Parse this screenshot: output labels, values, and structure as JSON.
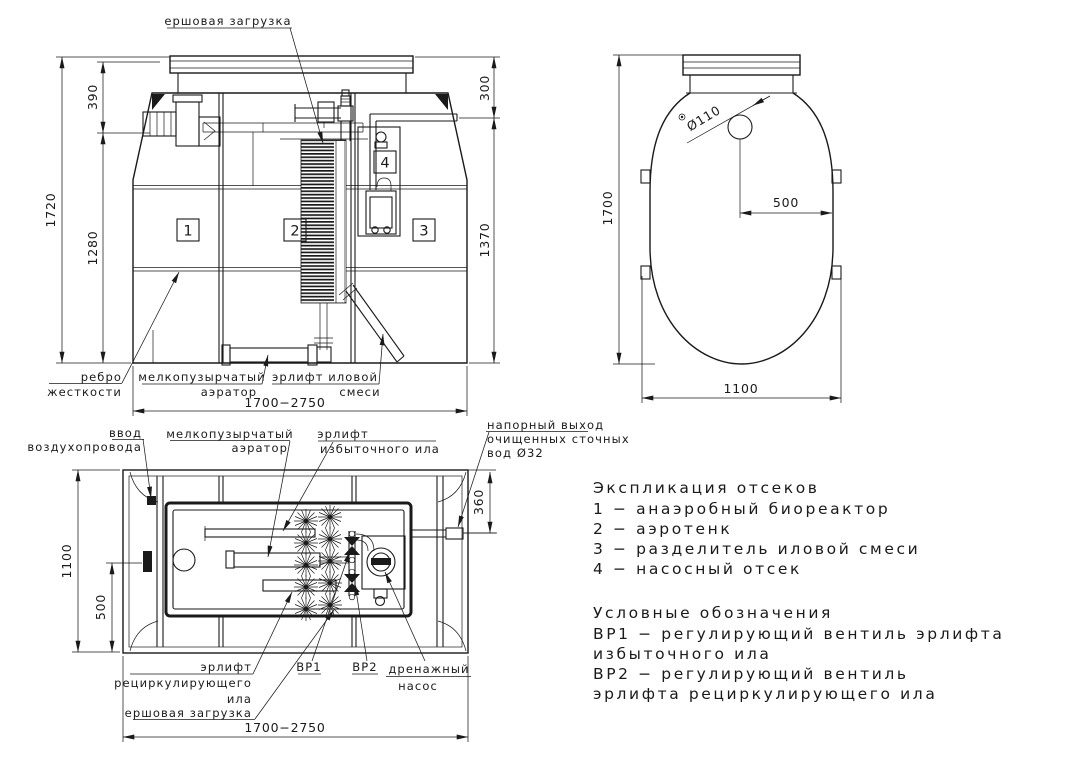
{
  "meta": {
    "ink": "#1a1a1a",
    "bg": "#ffffff",
    "drawing_type": "technical drawing of sewage treatment unit"
  },
  "front_view": {
    "callouts": {
      "brush_media": "ершовая загрузка",
      "rib_1": "ребро",
      "rib_2": "жесткости",
      "aerator_1": "мелкопузырчатый",
      "aerator_2": "аэратор",
      "sludge_airlift_1": "эрлифт иловой",
      "sludge_airlift_2": "смеси"
    },
    "dims": {
      "total_height": "1720",
      "top": "390",
      "middle": "1280",
      "right_top": "300",
      "right_bottom": "1370",
      "width_range": "1700−2750"
    },
    "compartments": {
      "c1": "1",
      "c2": "2",
      "c3": "3",
      "c4": "4"
    }
  },
  "side_view": {
    "dims": {
      "height": "1700",
      "hole_diameter": "Ø110",
      "hole_offset": "500",
      "width": "1100"
    }
  },
  "plan_view": {
    "callouts": {
      "air_inlet_1": "ввод",
      "air_inlet_2": "воздухопровода",
      "aerator_1": "мелкопузырчатый",
      "aerator_2": "аэратор",
      "excess_airlift_1": "эрлифт",
      "excess_airlift_2": "избыточного ила",
      "outlet_1": "напорный выход",
      "outlet_2": "очищенных сточных",
      "outlet_3": "вод Ø32",
      "recirc_airlift_1": "эрлифт",
      "recirc_airlift_2": "рециркулирующего",
      "recirc_airlift_3": "ила",
      "brush_media": "ершовая загрузка",
      "vr1": "ВР1",
      "vr2": "ВР2",
      "drain_pump_1": "дренажный",
      "drain_pump_2": "насос"
    },
    "dims": {
      "width": "1100",
      "inlet_offset": "500",
      "outlet_offset": "360",
      "length_range": "1700−2750"
    }
  },
  "legend": {
    "compartments_title": "Экспликация отсеков",
    "compartment_items": [
      "1 − анаэробный биореактор",
      "2 − аэротенк",
      "3 − разделитель иловой смеси",
      "4 − насосный отсек"
    ],
    "symbols_title": "Условные обозначения",
    "symbol_lines": [
      "ВР1 − регулирующий вентиль эрлифта",
      "избыточного ила",
      "ВР2 − регулирующий вентиль",
      "эрлифта рециркулирующего ила"
    ]
  }
}
